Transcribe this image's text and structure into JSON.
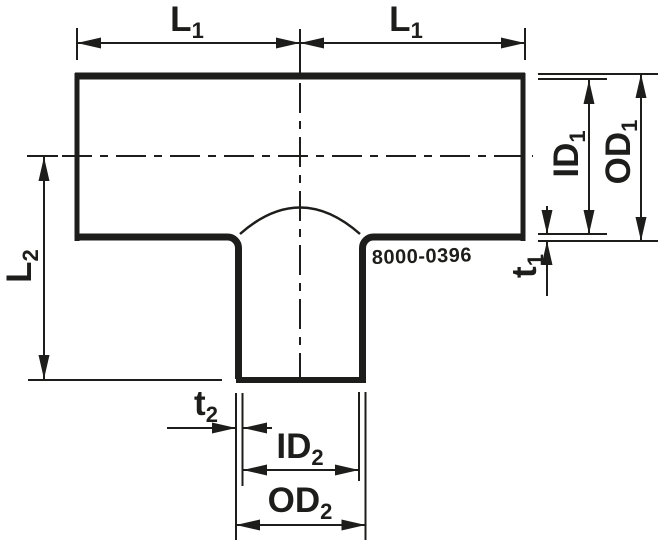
{
  "drawing": {
    "kind": "reducing-tee-technical-drawing",
    "part_number": "8000-0396",
    "colors": {
      "line": "#1d1d1b",
      "background": "#ffffff"
    },
    "dimensions": {
      "l1": {
        "main": "L",
        "sub": "1"
      },
      "l2": {
        "main": "L",
        "sub": "2"
      },
      "id1": {
        "main": "ID",
        "sub": "1"
      },
      "od1": {
        "main": "OD",
        "sub": "1"
      },
      "t1": {
        "main": "t",
        "sub": "1"
      },
      "id2": {
        "main": "ID",
        "sub": "2"
      },
      "od2": {
        "main": "OD",
        "sub": "2"
      },
      "t2": {
        "main": "t",
        "sub": "2"
      }
    }
  }
}
